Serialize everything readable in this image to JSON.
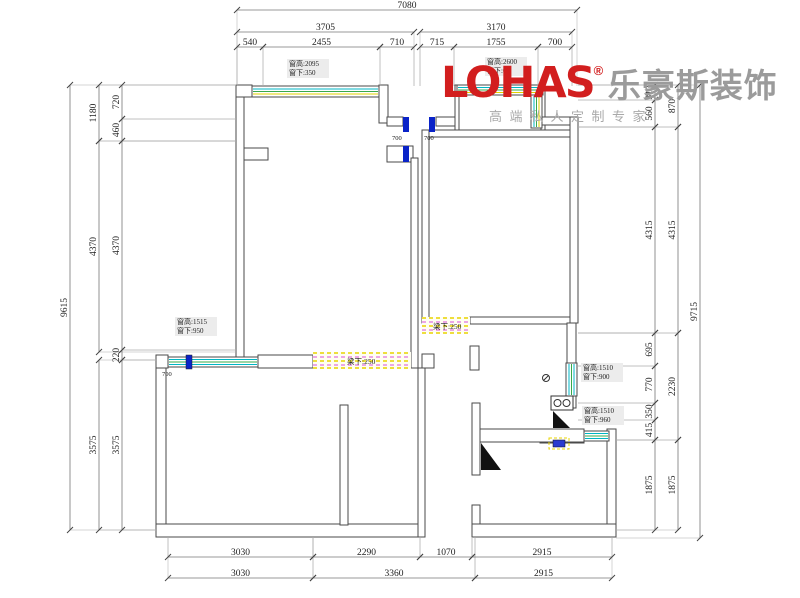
{
  "logo": {
    "brand": "LOHAS",
    "reg": "®",
    "brand_cn": "乐豪斯装饰",
    "tagline": "高端私人定制专家",
    "brand_color": "#d21e1e",
    "gray_color": "#9b9b9b"
  },
  "colors": {
    "wall_line": "#4a4a4a",
    "dim_line": "#777777",
    "ext_line": "#999999",
    "dim_text": "#222222",
    "window_cyan": "#00b6c4",
    "window_green": "#3aa84a",
    "window_yellow": "#e2d200",
    "jamb_blue": "#0a23c8",
    "hatch_yellow": "#e8d400",
    "hatch_magenta": "#d94fd9"
  },
  "dimensions": {
    "top_rows": [
      {
        "y": 10,
        "segments": [
          {
            "value": "7080",
            "x1": 237,
            "x2": 577
          }
        ]
      },
      {
        "y": 32,
        "segments": [
          {
            "value": "3705",
            "x1": 237,
            "x2": 414
          },
          {
            "value": "3170",
            "x1": 420,
            "x2": 572
          }
        ]
      },
      {
        "y": 47,
        "segments": [
          {
            "value": "540",
            "x1": 237,
            "x2": 263
          },
          {
            "value": "2455",
            "x1": 263,
            "x2": 380
          },
          {
            "value": "710",
            "x1": 380,
            "x2": 414
          },
          {
            "value": "715",
            "x1": 420,
            "x2": 454
          },
          {
            "value": "1755",
            "x1": 454,
            "x2": 538
          },
          {
            "value": "700",
            "x1": 538,
            "x2": 572
          }
        ]
      }
    ],
    "bottom_rows": [
      {
        "y": 557,
        "segments": [
          {
            "value": "3030",
            "x1": 168,
            "x2": 313
          },
          {
            "value": "2290",
            "x1": 313,
            "x2": 420
          },
          {
            "value": "1070",
            "x1": 420,
            "x2": 472
          },
          {
            "value": "2915",
            "x1": 472,
            "x2": 612
          }
        ]
      },
      {
        "y": 578,
        "segments": [
          {
            "value": "3030",
            "x1": 168,
            "x2": 313
          },
          {
            "value": "3360",
            "x1": 313,
            "x2": 475
          },
          {
            "value": "2915",
            "x1": 475,
            "x2": 612
          }
        ]
      }
    ],
    "left_cols": [
      {
        "x": 70,
        "segments": [
          {
            "value": "9615",
            "y1": 85,
            "y2": 530
          }
        ]
      },
      {
        "x": 99,
        "segments": [
          {
            "value": "1180",
            "y1": 85,
            "y2": 141
          },
          {
            "value": "4370",
            "y1": 141,
            "y2": 352
          },
          {
            "value": "3575",
            "y1": 360,
            "y2": 530
          }
        ]
      },
      {
        "x": 122,
        "segments": [
          {
            "value": "720",
            "y1": 85,
            "y2": 119
          },
          {
            "value": "460",
            "y1": 119,
            "y2": 141
          },
          {
            "value": "4370",
            "y1": 141,
            "y2": 350
          },
          {
            "value": "220",
            "y1": 350,
            "y2": 360
          },
          {
            "value": "3575",
            "y1": 360,
            "y2": 530
          }
        ]
      }
    ],
    "right_cols": [
      {
        "x": 655,
        "segments": [
          {
            "value": "310",
            "y1": 85,
            "y2": 100
          },
          {
            "value": "560",
            "y1": 100,
            "y2": 127
          },
          {
            "value": "4315",
            "y1": 127,
            "y2": 333
          },
          {
            "value": "695",
            "y1": 333,
            "y2": 366
          },
          {
            "value": "770",
            "y1": 366,
            "y2": 403
          },
          {
            "value": "350",
            "y1": 403,
            "y2": 420
          },
          {
            "value": "415",
            "y1": 420,
            "y2": 440
          },
          {
            "value": "1875",
            "y1": 440,
            "y2": 530
          }
        ]
      },
      {
        "x": 678,
        "segments": [
          {
            "value": "870",
            "y1": 85,
            "y2": 127
          },
          {
            "value": "4315",
            "y1": 127,
            "y2": 333
          },
          {
            "value": "2230",
            "y1": 333,
            "y2": 440
          },
          {
            "value": "1875",
            "y1": 440,
            "y2": 530
          }
        ]
      },
      {
        "x": 700,
        "segments": [
          {
            "value": "9715",
            "y1": 85,
            "y2": 538
          }
        ]
      }
    ]
  },
  "annotations": {
    "window_labels": [
      {
        "line1": "窗高:2095",
        "line2": "窗下:350",
        "x": 289,
        "y": 66
      },
      {
        "line1": "窗高:2600",
        "line2": "窗下:0",
        "x": 487,
        "y": 64
      },
      {
        "line1": "窗高:1515",
        "line2": "窗下:950",
        "x": 177,
        "y": 324
      },
      {
        "line1": "窗高:1510",
        "line2": "窗下:900",
        "x": 583,
        "y": 370
      },
      {
        "line1": "窗高:1510",
        "line2": "窗下:960",
        "x": 584,
        "y": 413
      }
    ],
    "beam_labels": [
      {
        "text": "梁下:250",
        "x": 347,
        "y": 364
      },
      {
        "text": "梁下:250",
        "x": 433,
        "y": 329
      }
    ],
    "opening_labels": [
      {
        "text": "700",
        "x": 392,
        "y": 140
      },
      {
        "text": "700",
        "x": 424,
        "y": 140
      },
      {
        "text": "700",
        "x": 162,
        "y": 376
      }
    ]
  }
}
